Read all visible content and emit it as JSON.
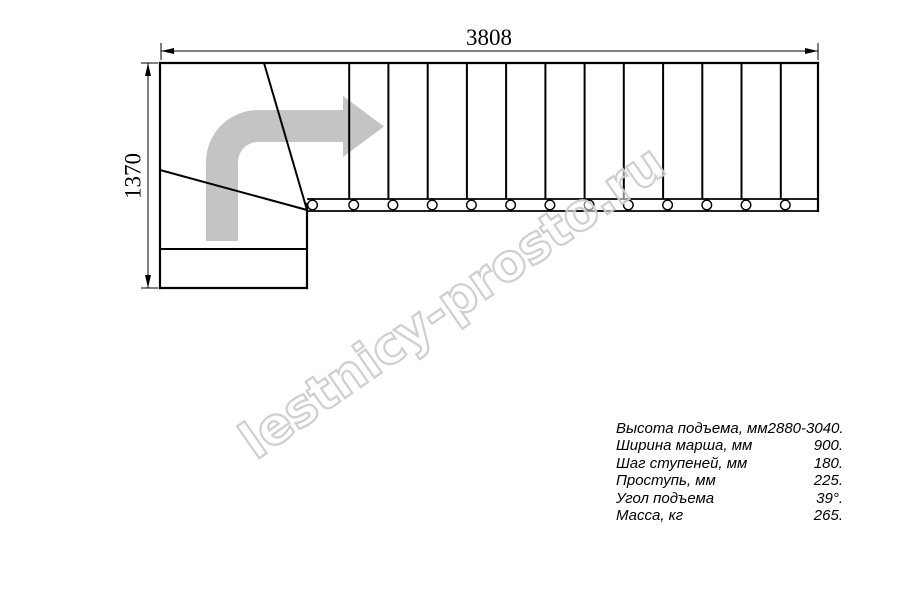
{
  "drawing": {
    "dimensions": {
      "width_mm": "3808",
      "height_mm": "1370"
    },
    "watermark_text": "lestnicy-prosto.ru",
    "colors": {
      "line": "#000000",
      "arrow_fill": "#c4c4c4",
      "watermark_stroke": "#cdcdcd"
    }
  },
  "stairs": {
    "straight_tread_count": 13,
    "winder_tread_count": 3,
    "tread_line_xs": [
      349.2,
      388.4,
      427.7,
      466.9,
      506.1,
      545.4,
      584.6,
      623.8,
      663.1,
      702.3,
      741.5,
      780.8
    ],
    "bolt_circle_xs": [
      312.5,
      353.7,
      392.9,
      432.2,
      471.4,
      510.6,
      549.9,
      589.1,
      628.3,
      667.6,
      706.8,
      746.0,
      785.3
    ]
  },
  "specs": {
    "rows": [
      {
        "label": "Высота подъема, мм",
        "value": "2880-3040."
      },
      {
        "label": "Ширина марша, мм",
        "value": "900."
      },
      {
        "label": "Шаг ступеней, мм",
        "value": "180."
      },
      {
        "label": "Проступь, мм",
        "value": "225."
      },
      {
        "label": "Угол подъема",
        "value": "39°."
      },
      {
        "label": "Масса, кг",
        "value": "265."
      }
    ]
  }
}
